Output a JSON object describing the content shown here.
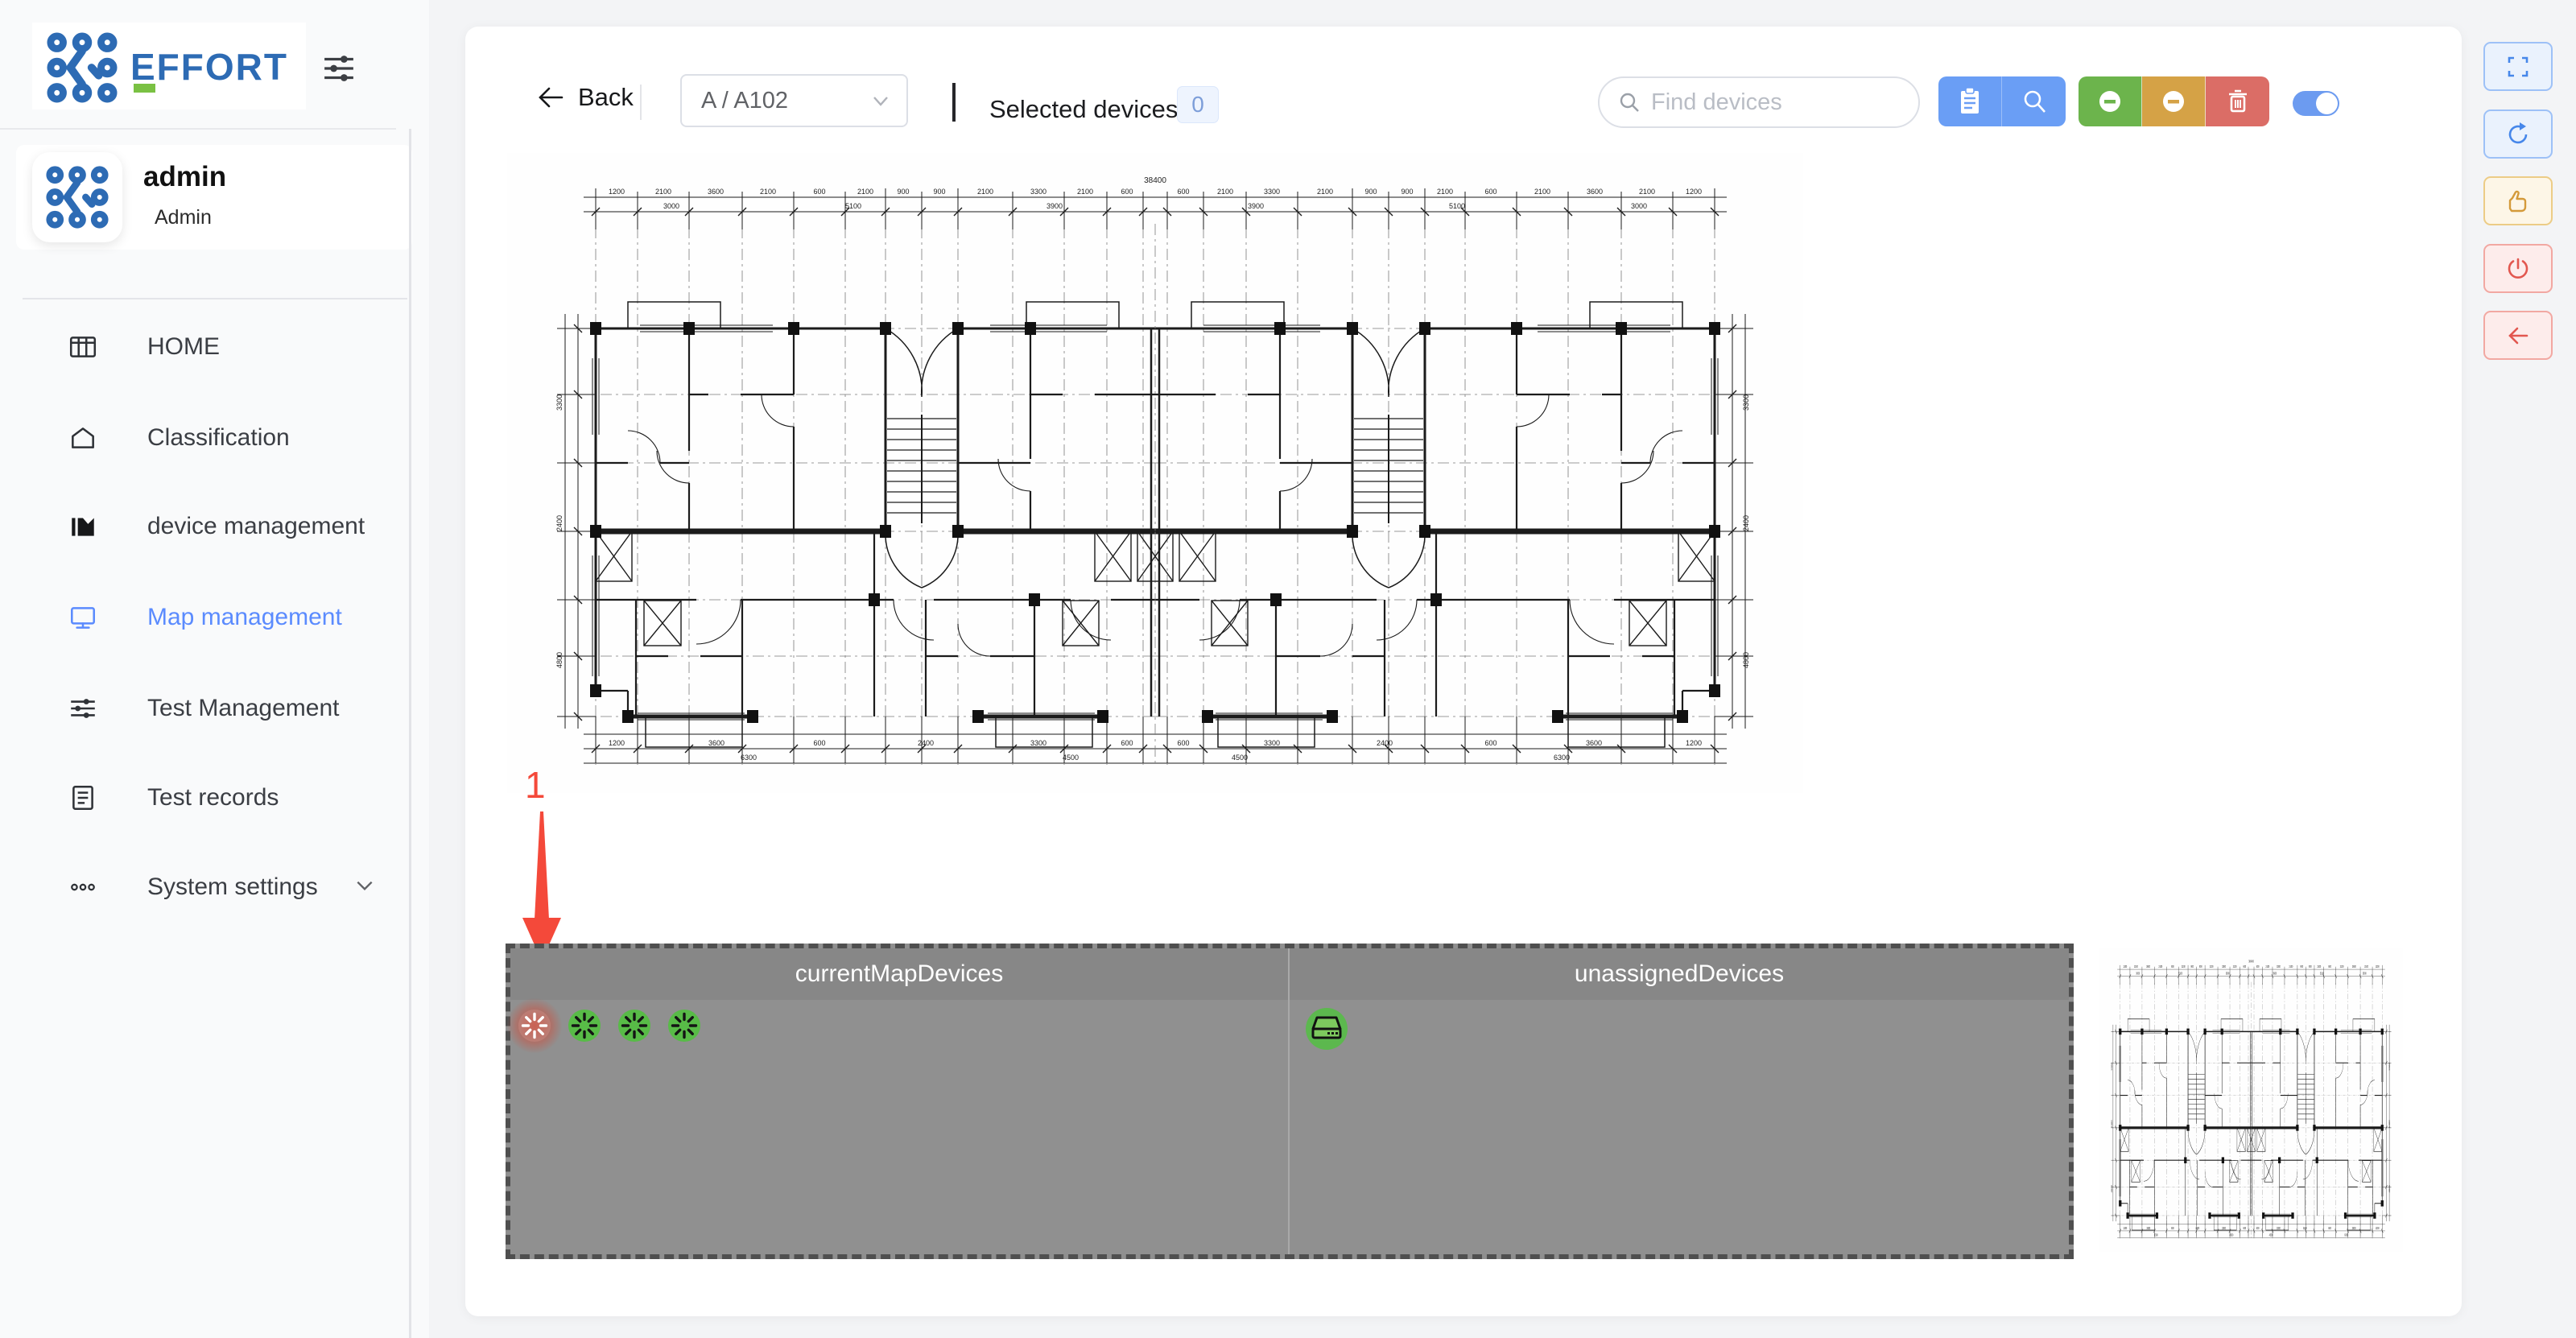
{
  "sidebar": {
    "logo_text": "EFFORT",
    "user": {
      "name": "admin",
      "role": "Admin"
    },
    "items": [
      {
        "label": "HOME"
      },
      {
        "label": "Classification"
      },
      {
        "label": "device management"
      },
      {
        "label": "Map management"
      },
      {
        "label": "Test Management"
      },
      {
        "label": "Test records"
      },
      {
        "label": "System settings"
      }
    ]
  },
  "toolbar": {
    "back_label": "Back",
    "area_select_value": "A / A102",
    "selected_devices_label": "Selected devices：",
    "selected_devices_count": "0",
    "search_placeholder": "Find devices",
    "action_icons": [
      "clipboard-icon",
      "magnifier-icon",
      "minus-circle-green-icon",
      "minus-circle-orange-icon",
      "trash-icon"
    ],
    "map_edit_toggle_on": true
  },
  "panels": {
    "current": {
      "title": "currentMapDevices",
      "device_count": 4
    },
    "unassigned": {
      "title": "unassignedDevices",
      "device_count": 1
    }
  },
  "annotation": {
    "step_label": "1"
  },
  "colors": {
    "accent_blue": "#5b8bfe",
    "button_blue": "#6a9ef5",
    "button_green": "#6cb44c",
    "button_orange": "#d5a246",
    "button_red": "#db6d66",
    "highlight_red": "#f4493a",
    "device_green": "#58bb47",
    "device_gray": "#a6a6a6",
    "zone_gray": "#909090"
  }
}
